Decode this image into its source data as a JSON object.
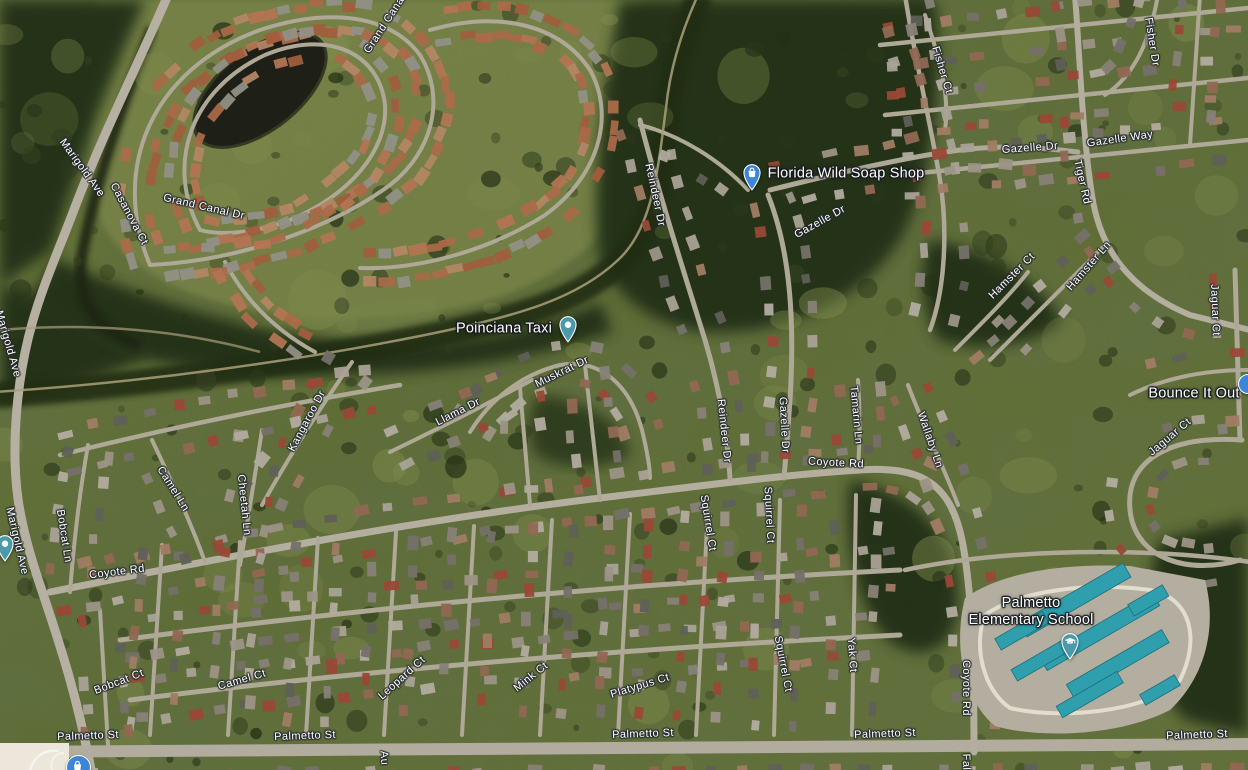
{
  "map": {
    "type": "satellite",
    "road_labels": [
      {
        "text": "Marigold Ave",
        "x": 82,
        "y": 168,
        "rot": 54
      },
      {
        "text": "Grand Canal",
        "x": 385,
        "y": 24,
        "rot": -57
      },
      {
        "text": "Casanova Ct",
        "x": 129,
        "y": 214,
        "rot": 62
      },
      {
        "text": "Grand Canal Dr",
        "x": 204,
        "y": 207,
        "rot": 13
      },
      {
        "text": "Marigold Ave",
        "x": 8,
        "y": 344,
        "rot": 74
      },
      {
        "text": "Marigold Ave",
        "x": 17,
        "y": 541,
        "rot": 77
      },
      {
        "text": "Bobcat Ln",
        "x": 64,
        "y": 536,
        "rot": 81
      },
      {
        "text": "Camel Ln",
        "x": 173,
        "y": 489,
        "rot": 58
      },
      {
        "text": "Cheetah Ln",
        "x": 244,
        "y": 505,
        "rot": 84
      },
      {
        "text": "Kangaroo Dr",
        "x": 307,
        "y": 421,
        "rot": -62
      },
      {
        "text": "Coyote Rd",
        "x": 117,
        "y": 572,
        "rot": -7
      },
      {
        "text": "Coyote Rd",
        "x": 836,
        "y": 463,
        "rot": 3
      },
      {
        "text": "Coyote Rd",
        "x": 966,
        "y": 688,
        "rot": 90
      },
      {
        "text": "Llama Dr",
        "x": 458,
        "y": 412,
        "rot": -27
      },
      {
        "text": "Muskrat Dr",
        "x": 562,
        "y": 372,
        "rot": -26
      },
      {
        "text": "Reindeer Dr",
        "x": 655,
        "y": 195,
        "rot": 78
      },
      {
        "text": "Reindeer Dr",
        "x": 724,
        "y": 431,
        "rot": 84
      },
      {
        "text": "Gazelle Dr",
        "x": 820,
        "y": 222,
        "rot": -29
      },
      {
        "text": "Gazelle Dr",
        "x": 784,
        "y": 425,
        "rot": 87
      },
      {
        "text": "Gazelle Dr",
        "x": 1030,
        "y": 148,
        "rot": -4
      },
      {
        "text": "Gazelle Way",
        "x": 1120,
        "y": 139,
        "rot": -8
      },
      {
        "text": "Tiger Rd",
        "x": 1082,
        "y": 182,
        "rot": 77
      },
      {
        "text": "Fisher Ct",
        "x": 942,
        "y": 70,
        "rot": 73
      },
      {
        "text": "Fisher Dr",
        "x": 1152,
        "y": 42,
        "rot": 81
      },
      {
        "text": "Hamster Ct",
        "x": 1012,
        "y": 276,
        "rot": -45
      },
      {
        "text": "Hamster Ln",
        "x": 1089,
        "y": 266,
        "rot": -49
      },
      {
        "text": "Jaguar Ct",
        "x": 1215,
        "y": 310,
        "rot": 88
      },
      {
        "text": "Jaguar Ct",
        "x": 1170,
        "y": 437,
        "rot": -40
      },
      {
        "text": "Wallaby Ln",
        "x": 930,
        "y": 440,
        "rot": 71
      },
      {
        "text": "Tamarin Ln",
        "x": 856,
        "y": 415,
        "rot": 85
      },
      {
        "text": "Squirrel Ct",
        "x": 708,
        "y": 523,
        "rot": 81
      },
      {
        "text": "Squirrel Ct",
        "x": 769,
        "y": 515,
        "rot": 87
      },
      {
        "text": "Bobcat Ct",
        "x": 119,
        "y": 682,
        "rot": -21
      },
      {
        "text": "Camel Ct",
        "x": 242,
        "y": 680,
        "rot": -16
      },
      {
        "text": "Leopard Ct",
        "x": 402,
        "y": 678,
        "rot": -42
      },
      {
        "text": "Mink Ct",
        "x": 531,
        "y": 677,
        "rot": -39
      },
      {
        "text": "Platypus Ct",
        "x": 640,
        "y": 686,
        "rot": -17
      },
      {
        "text": "Squirrel Ct",
        "x": 783,
        "y": 664,
        "rot": 79
      },
      {
        "text": "Yak Ct",
        "x": 852,
        "y": 655,
        "rot": 86
      },
      {
        "text": "Palmetto St",
        "x": 88,
        "y": 736,
        "rot": -2
      },
      {
        "text": "Palmetto St",
        "x": 305,
        "y": 736,
        "rot": -2
      },
      {
        "text": "Palmetto St",
        "x": 643,
        "y": 734,
        "rot": -2
      },
      {
        "text": "Palmetto St",
        "x": 885,
        "y": 734,
        "rot": -2
      },
      {
        "text": "Palmetto St",
        "x": 1197,
        "y": 735,
        "rot": -2
      },
      {
        "text": "Au",
        "x": 384,
        "y": 758,
        "rot": 86
      },
      {
        "text": "Fal",
        "x": 966,
        "y": 762,
        "rot": 88
      }
    ],
    "pois": [
      {
        "name": "Florida Wild Soap Shop",
        "category": "shop",
        "marker_color": "#3d85d8"
      },
      {
        "name": "Poinciana Taxi",
        "category": "place",
        "marker_color": "#4b9aab"
      },
      {
        "name": "Bounce It Out",
        "category": "shop",
        "marker_color": "#3d85d8"
      },
      {
        "name": "Palmetto Elementary School",
        "line1": "Palmetto",
        "line2": "Elementary School",
        "category": "school",
        "marker_color": "#4b9aab"
      }
    ],
    "colors": {
      "poi_blue": "#3d85d8",
      "poi_teal": "#4b9aab",
      "label_text": "#ffffff",
      "school_roof": "#2f9fae",
      "unloaded_tile": "#ece7da"
    }
  }
}
